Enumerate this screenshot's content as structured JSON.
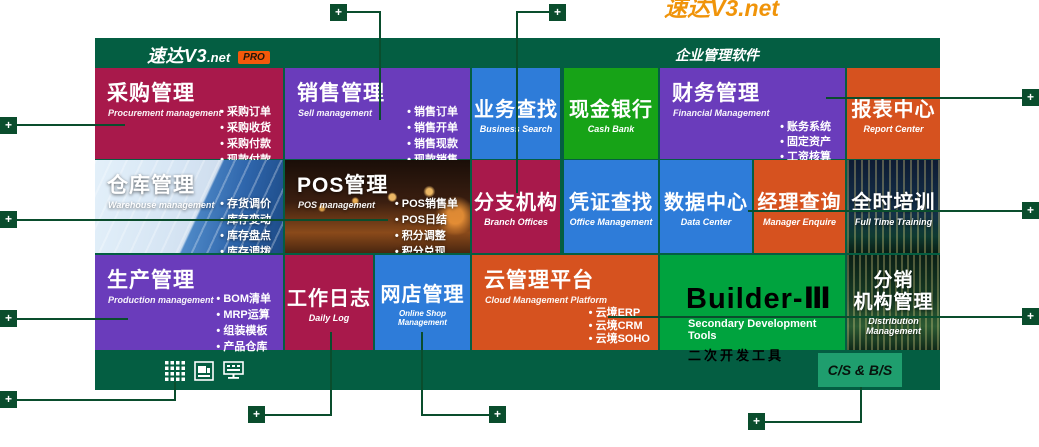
{
  "banner": {
    "clipped_text": "速达V3.net"
  },
  "header": {
    "logo_main": "速达V3",
    "logo_suffix": ".net",
    "badge": "PRO",
    "title": "企业管理软件"
  },
  "tiles": {
    "procurement": {
      "title": "采购管理",
      "subtitle": "Procurement management",
      "bullets": [
        "采购订单",
        "采购收货",
        "采购付款",
        "现款付款"
      ]
    },
    "sell": {
      "title": "销售管理",
      "subtitle": "Sell management",
      "bullets": [
        "销售订单",
        "销售开单",
        "销售现款",
        "现款销售"
      ]
    },
    "business_search": {
      "title": "业务查找",
      "subtitle": "Business Search"
    },
    "cash_bank": {
      "title": "现金银行",
      "subtitle": "Cash Bank"
    },
    "financial": {
      "title": "财务管理",
      "subtitle": "Financial Management",
      "bullets": [
        "账务系统",
        "固定资产",
        "工资核算"
      ]
    },
    "report_center": {
      "title": "报表中心",
      "subtitle": "Report Center"
    },
    "warehouse": {
      "title": "仓库管理",
      "subtitle": "Warehouse management",
      "bullets": [
        "存货调价",
        "库存变动",
        "库存盘点",
        "库存调拨"
      ]
    },
    "pos": {
      "title": "POS管理",
      "subtitle": "POS management",
      "bullets": [
        "POS销售单",
        "POS日结",
        "积分调整",
        "积分兑现"
      ]
    },
    "branch": {
      "title": "分支机构",
      "subtitle": "Branch Offices"
    },
    "voucher": {
      "title": "凭证查找",
      "subtitle": "Office Management"
    },
    "data_center": {
      "title": "数据中心",
      "subtitle": "Data Center"
    },
    "manager": {
      "title": "经理查询",
      "subtitle": "Manager Enquire"
    },
    "training": {
      "title": "全时培训",
      "subtitle": "Full Time Training"
    },
    "production": {
      "title": "生产管理",
      "subtitle": "Production management",
      "bullets": [
        "BOM清单",
        "MRP运算",
        "组装模板",
        "产品仓库"
      ]
    },
    "daily_log": {
      "title": "工作日志",
      "subtitle": "Daily Log"
    },
    "online_shop": {
      "title": "网店管理",
      "subtitle": "Online Shop Management"
    },
    "cloud": {
      "title": "云管理平台",
      "subtitle": "Cloud Management Platform",
      "bullets": [
        "云境ERP",
        "云境CRM",
        "云境SOHO"
      ]
    },
    "builder": {
      "title": "Builder-Ⅲ",
      "subtitle": "Secondary Development Tools",
      "subtitle_cn": "二次开发工具"
    },
    "distribution": {
      "title_line1": "分销",
      "title_line2": "机构管理",
      "subtitle": "Distribution Management"
    }
  },
  "footer": {
    "cs_bs": "C/S & B/S"
  },
  "markers": {
    "plus": "+"
  },
  "colors": {
    "panel_green": "#045E42",
    "marker_green": "#0A4D2D",
    "crimson": "#A8194B",
    "purple": "#6A3CBB",
    "blue": "#2E7CD9",
    "green": "#17A317",
    "builder_green": "#00A33E",
    "orange": "#D6521F",
    "cs_badge_green": "#1F9E6E",
    "pro_badge_orange": "#F4590A",
    "banner_orange": "#F0940A"
  }
}
